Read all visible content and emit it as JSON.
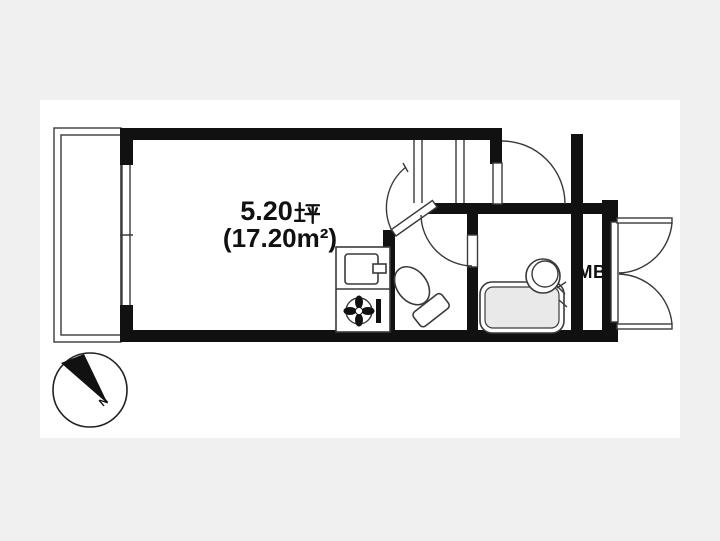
{
  "page": {
    "background": "#f0f0f0",
    "canvas_background": "#ffffff",
    "description": "Japanese studio apartment floor plan"
  },
  "floor_plan": {
    "area_label": {
      "tsubo_value": "5.20",
      "tsubo_unit": "坪",
      "tsubo_full": "5.20坪",
      "m2_full": "(17.20㎡)",
      "m2_display": "(17.20m²)"
    },
    "meter_box_label": "MB",
    "compass_north_label": "N",
    "fixtures": [
      "balcony",
      "sliding-window",
      "main-room",
      "diagonal-door",
      "kitchen-sink",
      "stove-burner",
      "toilet",
      "bathtub",
      "wash-basin",
      "entry-door",
      "meter-box",
      "double-doors",
      "compass"
    ],
    "colors": {
      "wall": "#111111",
      "line": "#3a3a3a",
      "tub_fill": "#e9e9e9",
      "background": "#f0f0f0",
      "canvas": "#ffffff"
    }
  }
}
